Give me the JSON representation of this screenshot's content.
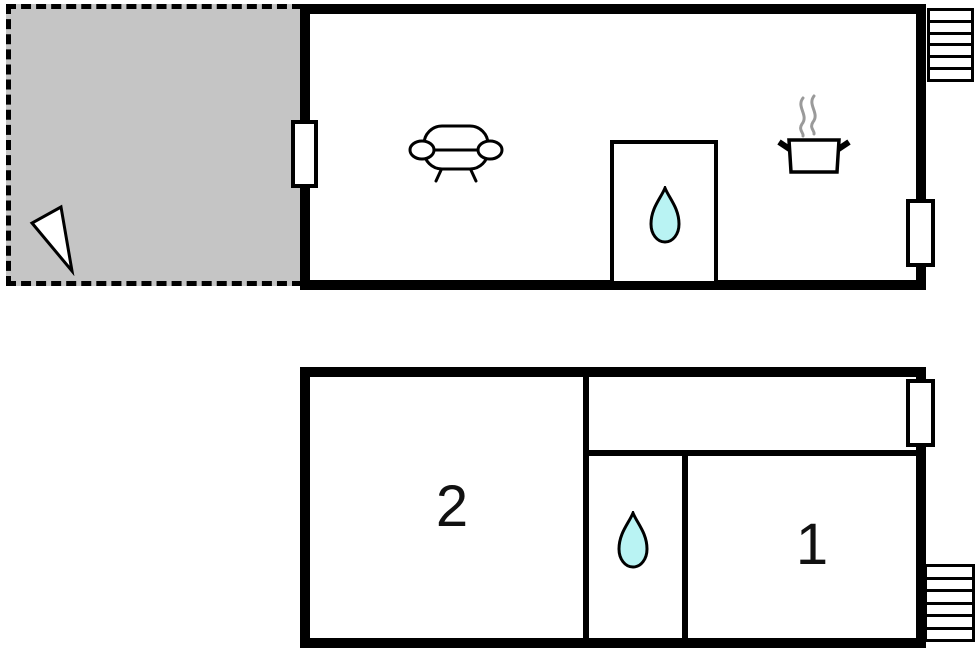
{
  "title": "floor-plan",
  "colors": {
    "wall": "#000000",
    "terrace_fill": "#c5c5c5",
    "water_fill": "#b9f3f3",
    "steam": "#9a9a9a",
    "floor_fill": "#ffffff",
    "label_color": "#111111"
  },
  "upper_floor": {
    "terrace": {
      "icon": "north-arrow-icon",
      "outline": "dashed"
    },
    "living_room": {
      "icons": [
        "sofa-icon",
        "cooking-pot-icon",
        "steam-icon"
      ]
    },
    "bathroom": {
      "icon": "water-drop-icon"
    },
    "openings": {
      "door": "terrace-door",
      "window": "right-wall-window"
    },
    "stairs": {
      "icon": "stairs-icon",
      "steps": 6
    }
  },
  "lower_floor": {
    "room_2": {
      "label": "2"
    },
    "room_1": {
      "label": "1"
    },
    "bathroom": {
      "icon": "water-drop-icon"
    },
    "hallway": {},
    "openings": {
      "window": "right-wall-window"
    },
    "stairs": {
      "icon": "stairs-icon",
      "steps": 6
    }
  }
}
